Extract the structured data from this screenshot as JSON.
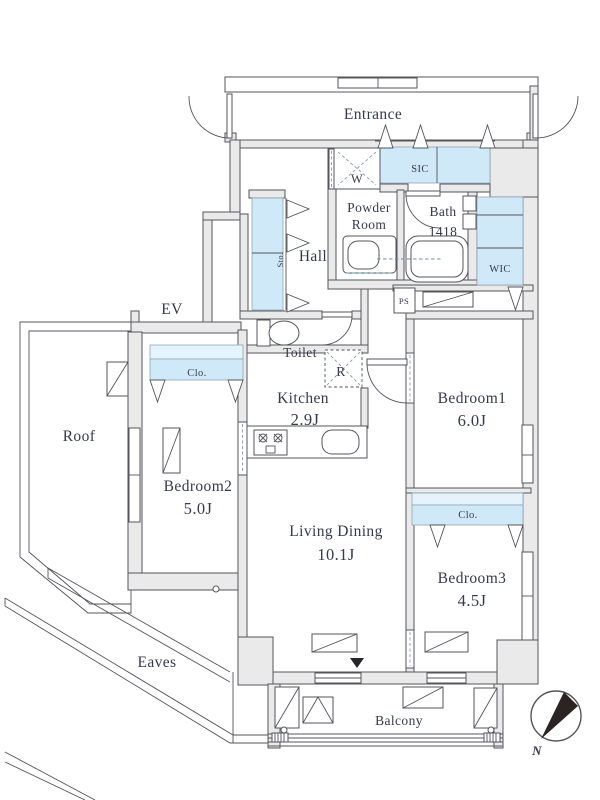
{
  "labels": {
    "entrance": "Entrance",
    "sic": "SIC",
    "washer": "W",
    "powder_room": [
      "Powder",
      "Room"
    ],
    "bath": [
      "Bath",
      "1418"
    ],
    "wic": "WIC",
    "hall": "Hall",
    "storage": "Sto.",
    "elevator": "EV",
    "toilet": "Toilet",
    "refrigerator": "R",
    "pipe_space": "PS",
    "kitchen": {
      "name": "Kitchen",
      "area": "2.9J"
    },
    "bedroom1": {
      "name": "Bedroom1",
      "area": "6.0J"
    },
    "bedroom2": {
      "name": "Bedroom2",
      "area": "5.0J"
    },
    "bedroom3": {
      "name": "Bedroom3",
      "area": "4.5J"
    },
    "living_dining": {
      "name": "Living Dining",
      "area": "10.1J"
    },
    "closet_bedroom1": "Clo.",
    "closet_bedroom2": "Clo.",
    "roof": "Roof",
    "eaves": "Eaves",
    "balcony": "Balcony",
    "north": "N"
  },
  "colors": {
    "wall_fill": "#eaeaea",
    "wall_stroke": "#54555c",
    "closet_fill": "#cfe9f8",
    "closet_fill_light": "#e4f3fc",
    "text": "#343b4c",
    "plumbing_dash": "#5f93ad",
    "marker_dark": "#26262a"
  }
}
